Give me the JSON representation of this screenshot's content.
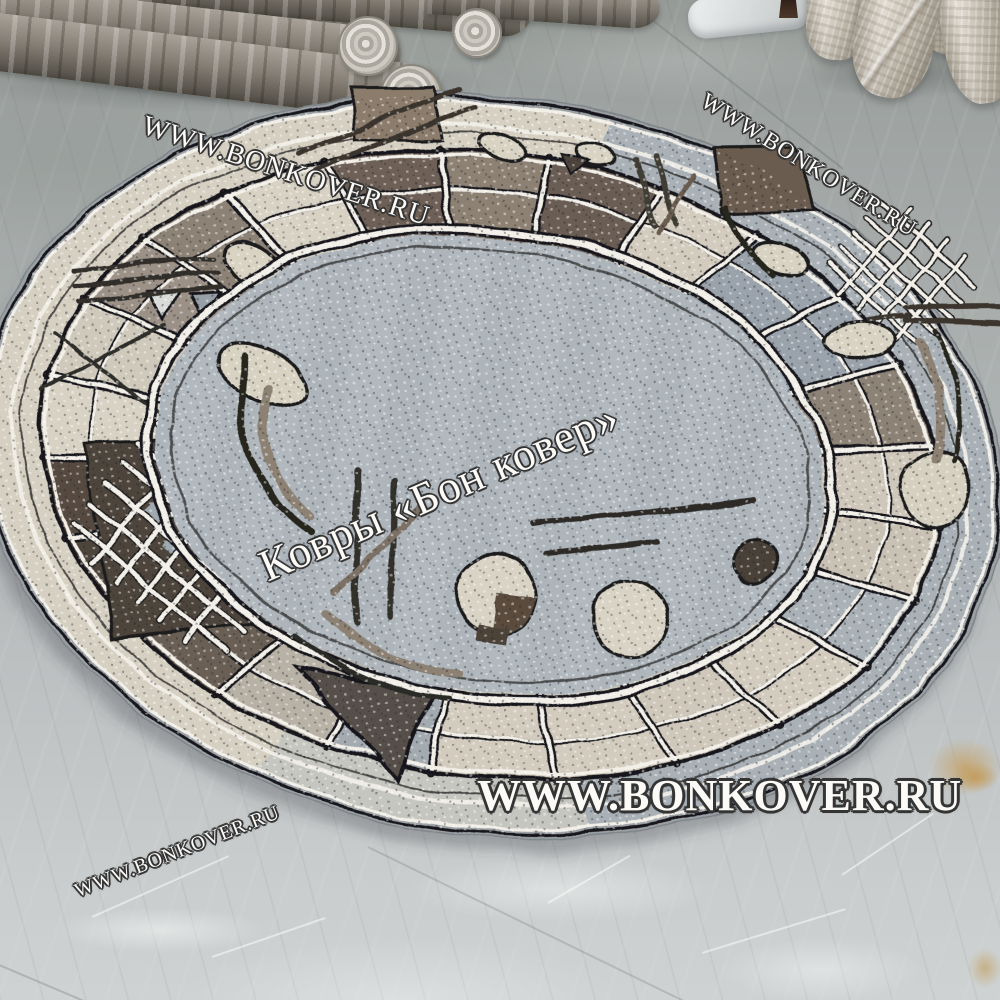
{
  "watermarks": {
    "top_left": "WWW.BONKOVER.RU",
    "top_right": "WWW.BONKOVER.RU",
    "center": "Ковры «Бон ковер»",
    "bottom_main": "WWW.BONKOVER.RU",
    "bottom_left": "WWW.BONKOVER.RU"
  },
  "colors": {
    "floor": "#b3b7b8",
    "rug_field": "#adb5bb",
    "rug_border_cream": "#d6d0c2",
    "rug_border_brown": "#55493f",
    "rug_border_taupe": "#8d8173",
    "rug_border_gray": "#a3aab0",
    "rug_outer_band_gray": "#a9b1b7",
    "rug_binding": "#9ba1a5",
    "rug_outline_dark": "#17171a",
    "rug_outline_light": "#f2efe8",
    "watermark_text": "#fbfaf7"
  }
}
